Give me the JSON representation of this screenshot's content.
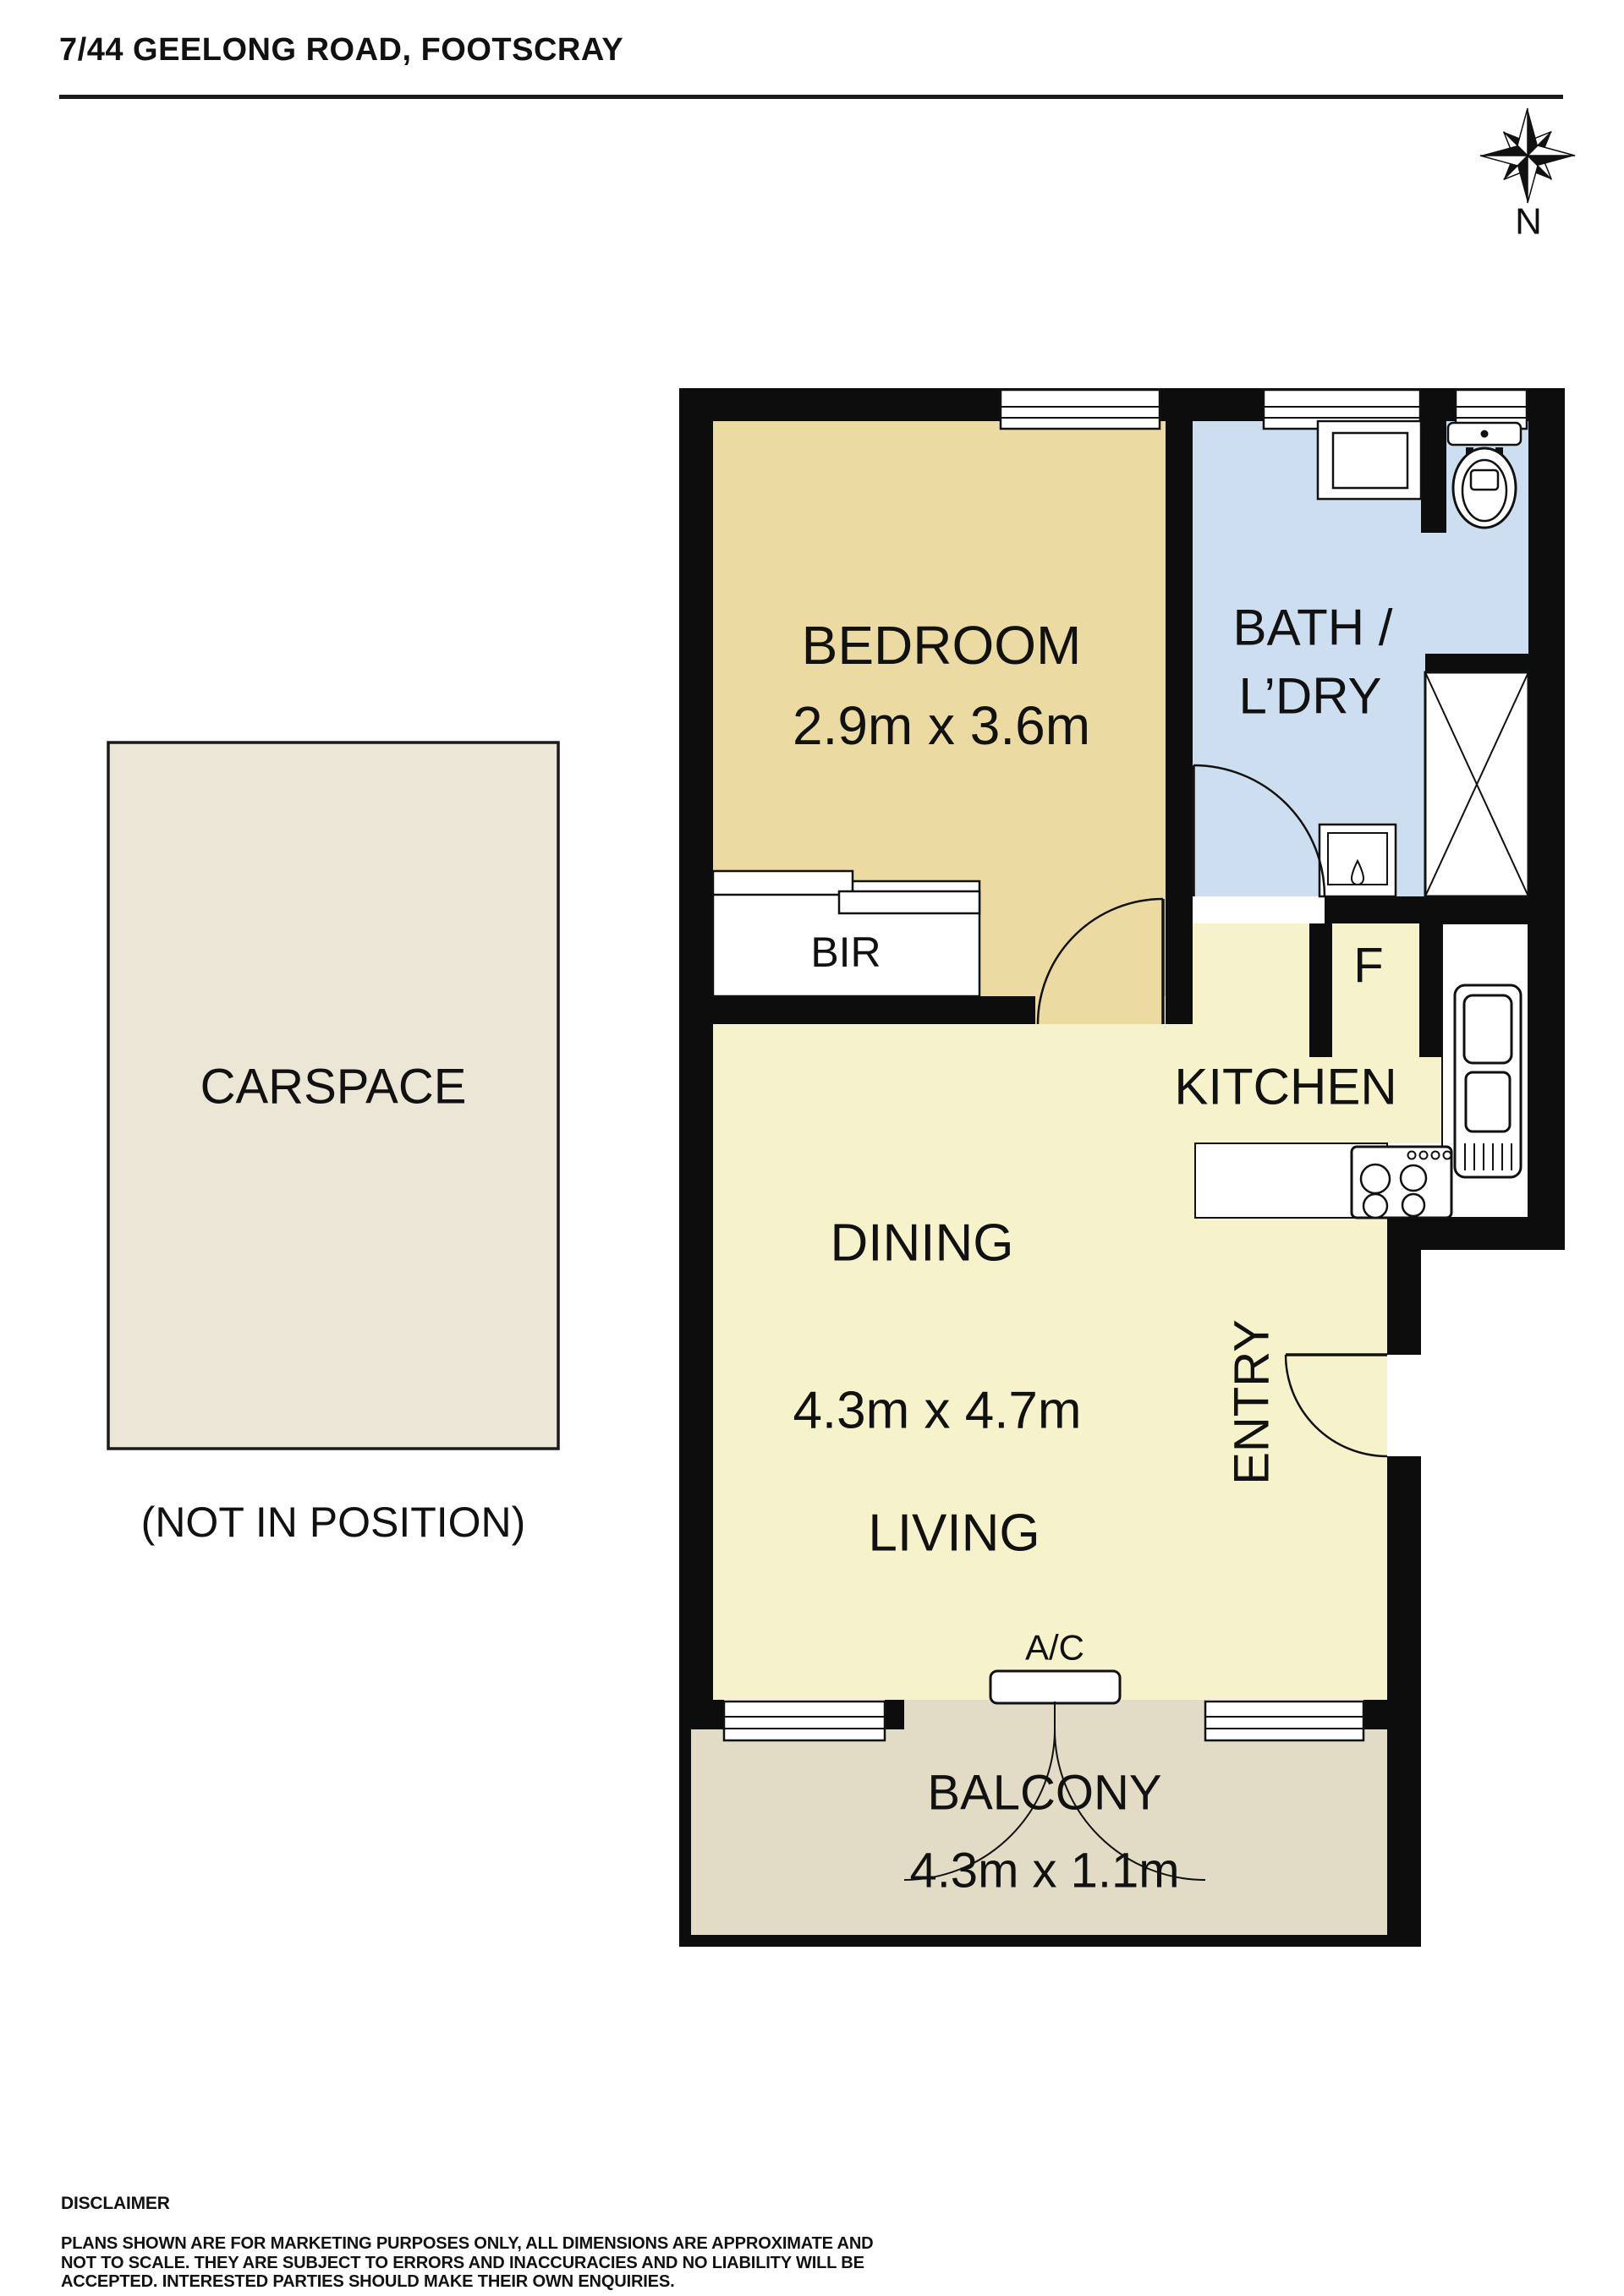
{
  "header": {
    "title": "7/44 GEELONG ROAD, FOOTSCRAY"
  },
  "compass": {
    "north_label": "N"
  },
  "carspace": {
    "label": "CARSPACE",
    "note": "(NOT IN POSITION)"
  },
  "rooms": {
    "bedroom": {
      "label": "BEDROOM",
      "dims": "2.9m x 3.6m"
    },
    "bath": {
      "line1": "BATH /",
      "line2": "L’DRY"
    },
    "bir": {
      "label": "BIR"
    },
    "fridge": {
      "label": "F"
    },
    "kitchen": {
      "label": "KITCHEN"
    },
    "dining": {
      "label": "DINING"
    },
    "living_area": {
      "dims": "4.3m x 4.7m"
    },
    "living": {
      "label": "LIVING"
    },
    "entry": {
      "label": "ENTRY"
    },
    "ac": {
      "label": "A/C"
    },
    "balcony": {
      "label": "BALCONY",
      "dims": "4.3m x 1.1m"
    }
  },
  "disclaimer": {
    "heading": "DISCLAIMER",
    "lines": [
      "PLANS SHOWN ARE FOR MARKETING PURPOSES ONLY, ALL DIMENSIONS ARE APPROXIMATE AND",
      "NOT TO SCALE. THEY ARE SUBJECT TO ERRORS AND INACCURACIES AND NO LIABILITY WILL BE",
      "ACCEPTED. INTERESTED PARTIES SHOULD MAKE THEIR OWN ENQUIRIES."
    ]
  },
  "colors": {
    "wall": "#0d0d0d",
    "bedroom": "#ebdaa1",
    "bath": "#cddef1",
    "living": "#f6f2cc",
    "balcony": "#e2dbc5",
    "carspace": "#ebe6d5",
    "accent_line": "#111111"
  }
}
